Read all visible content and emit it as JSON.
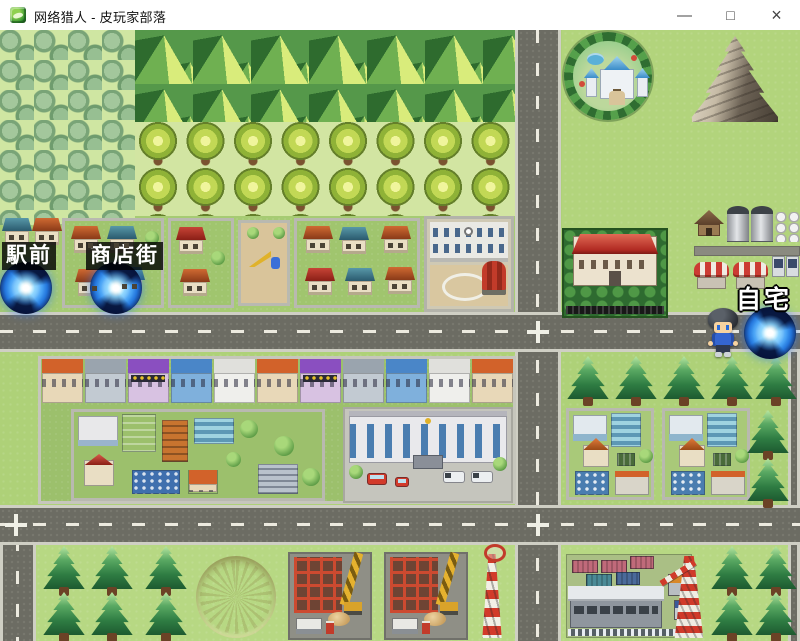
{
  "window": {
    "title": "网络猎人 - 皮玩家部落",
    "controls": {
      "minimize": "—",
      "maximize": "□",
      "close": "×"
    }
  },
  "map": {
    "labels": {
      "ekimae": "駅前",
      "shotengai": "商店街",
      "jitaku": "自宅"
    },
    "landmarks": [
      "forest",
      "green-mountain-ridge",
      "tree-grove",
      "station-town",
      "school",
      "castle-park",
      "rocky-mountain",
      "red-roof-mansion",
      "farmstead",
      "shopping-street-row",
      "downtown-block",
      "city-hall",
      "city-block",
      "crater",
      "construction-site",
      "radio-tower",
      "container-depot",
      "oil-derrick"
    ],
    "icons": {
      "portal": "blue-swirl-portal",
      "player": "player-character-sprite"
    }
  },
  "colors": {
    "title_bg": "#ffffff",
    "grass": "#aed178",
    "grass_pale": "#d2e5a2",
    "road": "#6c6c63",
    "road_dash": "#eceadf",
    "portal_blue": "#1c6fd6",
    "label_bg": "rgba(0,0,0,0.8)",
    "label_text": "#ffffff"
  }
}
